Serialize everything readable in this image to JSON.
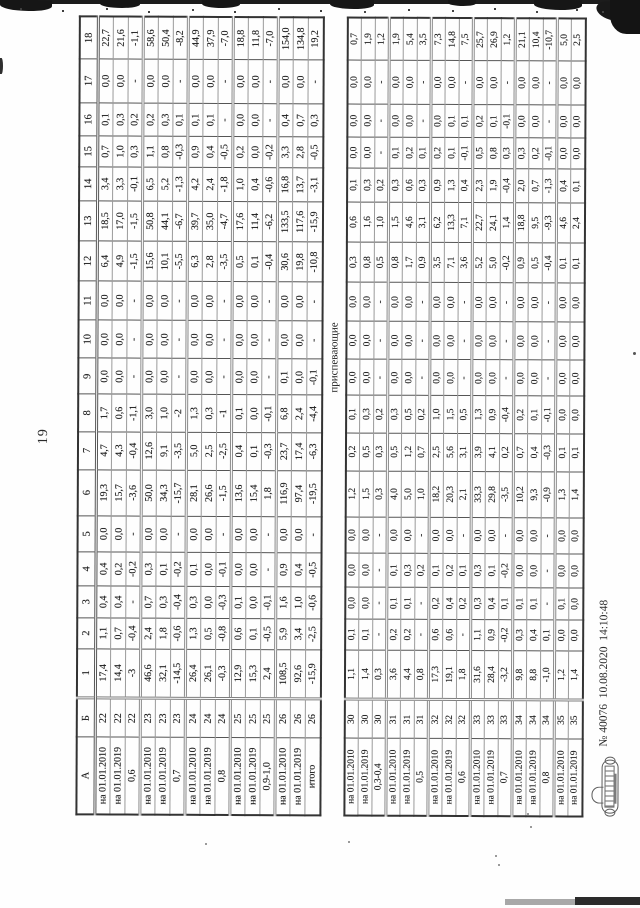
{
  "page": {
    "number": "19"
  },
  "table": {
    "header": [
      "А",
      "Б",
      "1",
      "2",
      "3",
      "4",
      "5",
      "6",
      "7",
      "8",
      "9",
      "10",
      "11",
      "12",
      "13",
      "14",
      "15",
      "16",
      "17",
      "18"
    ],
    "block1": {
      "rows": [
        [
          "на 01.01.2010",
          "22",
          "17,4",
          "1,1",
          "0,4",
          "0,4",
          "0,0",
          "19,3",
          "4,7",
          "1,7",
          "0,0",
          "0,0",
          "0,0",
          "6,4",
          "18,5",
          "3,4",
          "0,7",
          "0,1",
          "0,0",
          "22,7"
        ],
        [
          "на 01.01.2019",
          "22",
          "14,4",
          "0,7",
          "0,4",
          "0,2",
          "0,0",
          "15,7",
          "4,3",
          "0,6",
          "0,0",
          "0,0",
          "0,0",
          "4,9",
          "17,0",
          "3,3",
          "1,0",
          "0,3",
          "0,0",
          "21,6"
        ],
        [
          "0,6",
          "22",
          "-3",
          "-0,4",
          "-",
          "-0,2",
          "-",
          "-3,6",
          "-0,4",
          "-1,1",
          "-",
          "-",
          "-",
          "-1,5",
          "-1,5",
          "-0,1",
          "0,3",
          "0,2",
          "-",
          "-1,1"
        ],
        [
          "на 01.01.2010",
          "23",
          "46,6",
          "2,4",
          "0,7",
          "0,3",
          "0,0",
          "50,0",
          "12,6",
          "3,0",
          "0,0",
          "0,0",
          "0,0",
          "15,6",
          "50,8",
          "6,5",
          "1,1",
          "0,2",
          "0,0",
          "58,6"
        ],
        [
          "на 01.01.2019",
          "23",
          "32,1",
          "1,8",
          "0,3",
          "0,1",
          "0,0",
          "34,3",
          "9,1",
          "1,0",
          "0,0",
          "0,0",
          "0,0",
          "10,1",
          "44,1",
          "5,2",
          "0,8",
          "0,3",
          "0,0",
          "50,4"
        ],
        [
          "0,7",
          "23",
          "-14,5",
          "-0,6",
          "-0,4",
          "-0,2",
          "-",
          "-15,7",
          "-3,5",
          "-2",
          "-",
          "-",
          "-",
          "-5,5",
          "-6,7",
          "-1,3",
          "-0,3",
          "0,1",
          "-",
          "-8,2"
        ],
        [
          "на 01.01.2010",
          "24",
          "26,4",
          "1,3",
          "0,3",
          "0,1",
          "0,0",
          "28,1",
          "5,0",
          "1,3",
          "0,0",
          "0,0",
          "0,0",
          "6,3",
          "39,7",
          "4,2",
          "0,9",
          "0,1",
          "0,0",
          "44,9"
        ],
        [
          "на 01.01.2019",
          "24",
          "26,1",
          "0,5",
          "0,0",
          "0,0",
          "0,0",
          "26,6",
          "2,5",
          "0,3",
          "0,0",
          "0,0",
          "0,0",
          "2,8",
          "35,0",
          "2,4",
          "0,4",
          "0,1",
          "0,0",
          "37,9"
        ],
        [
          "0,8",
          "24",
          "-0,3",
          "-0,8",
          "-0,3",
          "-0,1",
          "-",
          "-1,5",
          "-2,5",
          "-1",
          "-",
          "-",
          "-",
          "-3,5",
          "-4,7",
          "-1,8",
          "-0,5",
          "-",
          "-",
          "-7,0"
        ],
        [
          "на 01.01.2010",
          "25",
          "12,9",
          "0,6",
          "0,1",
          "0,0",
          "0,0",
          "13,6",
          "0,4",
          "0,1",
          "0,0",
          "0,0",
          "0,0",
          "0,5",
          "17,6",
          "1,0",
          "0,2",
          "0,0",
          "0,0",
          "18,8"
        ],
        [
          "на 01.01.2019",
          "25",
          "15,3",
          "0,1",
          "0,0",
          "0,0",
          "0,0",
          "15,4",
          "0,1",
          "0,0",
          "0,0",
          "0,0",
          "0,0",
          "0,1",
          "11,4",
          "0,4",
          "0,0",
          "0,0",
          "0,0",
          "11,8"
        ],
        [
          "0,9-1,0",
          "25",
          "2,4",
          "-0,5",
          "-0,1",
          "-",
          "-",
          "1,8",
          "-0,3",
          "-0,1",
          "-",
          "-",
          "-",
          "-0,4",
          "-6,2",
          "-0,6",
          "-0,2",
          "-",
          "-",
          "-7,0"
        ],
        [
          "на 01.01.2010",
          "26",
          "108,5",
          "5,9",
          "1,6",
          "0,9",
          "0,0",
          "116,9",
          "23,7",
          "6,8",
          "0,1",
          "0,0",
          "0,0",
          "30,6",
          "133,5",
          "16,8",
          "3,3",
          "0,4",
          "0,0",
          "154,0"
        ],
        [
          "на 01.01.2019",
          "26",
          "92,6",
          "3,4",
          "1,0",
          "0,4",
          "0,0",
          "97,4",
          "17,4",
          "2,4",
          "0,0",
          "0,0",
          "0,0",
          "19,8",
          "117,6",
          "13,7",
          "2,8",
          "0,7",
          "0,0",
          "134,8"
        ],
        [
          "итого",
          "26",
          "-15,9",
          "-2,5",
          "-0,6",
          "-0,5",
          "-",
          "-19,5",
          "-6,3",
          "-4,4",
          "-0,1",
          "-",
          "-",
          "-10,8",
          "-15,9",
          "-3,1",
          "-0,5",
          "0,3",
          "-",
          "19,2"
        ]
      ]
    },
    "block2": {
      "label": "приспевающие",
      "rows": [
        [
          "на 01.01.2010",
          "30",
          "1,1",
          "0,1",
          "0,0",
          "0,0",
          "0,0",
          "1,2",
          "0,2",
          "0,1",
          "0,0",
          "0,0",
          "0,0",
          "0,3",
          "0,6",
          "0,1",
          "0,0",
          "0,0",
          "0,0",
          "0,7"
        ],
        [
          "на 01.01.2019",
          "30",
          "1,4",
          "0,1",
          "0,0",
          "0,0",
          "0,0",
          "1,5",
          "0,5",
          "0,3",
          "0,0",
          "0,0",
          "0,0",
          "0,8",
          "1,6",
          "0,3",
          "0,0",
          "0,0",
          "0,0",
          "1,9"
        ],
        [
          "0,3-0,4",
          "30",
          "0,3",
          "-",
          "-",
          "-",
          "-",
          "0,3",
          "0,3",
          "0,2",
          "-",
          "-",
          "-",
          "0,5",
          "1,0",
          "0,2",
          "-",
          "-",
          "-",
          "1,2"
        ],
        [
          "на 01.01.2010",
          "31",
          "3,6",
          "0,2",
          "0,1",
          "0,1",
          "0,0",
          "4,0",
          "0,5",
          "0,3",
          "0,0",
          "0,0",
          "0,0",
          "0,8",
          "1,5",
          "0,3",
          "0,1",
          "0,0",
          "0,0",
          "1,9"
        ],
        [
          "на 01.01.2019",
          "31",
          "4,4",
          "0,2",
          "0,1",
          "0,3",
          "0,0",
          "5,0",
          "1,2",
          "0,5",
          "0,0",
          "0,0",
          "0,0",
          "1,7",
          "4,6",
          "0,6",
          "0,2",
          "0,0",
          "0,0",
          "5,4"
        ],
        [
          "0,5",
          "31",
          "0,8",
          "-",
          "-",
          "0,2",
          "-",
          "1,0",
          "0,7",
          "0,2",
          "-",
          "-",
          "-",
          "0,9",
          "3,1",
          "0,3",
          "0,1",
          "-",
          "-",
          "3,5"
        ],
        [
          "на 01.01.2010",
          "32",
          "17,3",
          "0,6",
          "0,2",
          "0,1",
          "0,0",
          "18,2",
          "2,5",
          "1,0",
          "0,0",
          "0,0",
          "0,0",
          "3,5",
          "6,2",
          "0,9",
          "0,2",
          "0,0",
          "0,0",
          "7,3"
        ],
        [
          "на 01.01.2019",
          "32",
          "19,1",
          "0,6",
          "0,4",
          "0,2",
          "0,0",
          "20,3",
          "5,6",
          "1,5",
          "0,0",
          "0,0",
          "0,0",
          "7,1",
          "13,3",
          "1,3",
          "0,1",
          "0,1",
          "0,0",
          "14,8"
        ],
        [
          "0,6",
          "32",
          "1,8",
          "-",
          "0,2",
          "0,1",
          "-",
          "2,1",
          "3,1",
          "0,5",
          "-",
          "-",
          "-",
          "3,6",
          "7,1",
          "0,4",
          "-0,1",
          "0,1",
          "-",
          "7,5"
        ],
        [
          "на 01.01.2010",
          "33",
          "31,6",
          "1,1",
          "0,3",
          "0,3",
          "0,0",
          "33,3",
          "3,9",
          "1,3",
          "0,0",
          "0,0",
          "0,0",
          "5,2",
          "22,7",
          "2,3",
          "0,5",
          "0,2",
          "0,0",
          "25,7"
        ],
        [
          "на 01.01.2019",
          "33",
          "28,4",
          "0,9",
          "0,4",
          "0,1",
          "0,0",
          "29,8",
          "4,1",
          "0,9",
          "0,0",
          "0,0",
          "0,0",
          "5,0",
          "24,1",
          "1,9",
          "0,8",
          "0,1",
          "0,0",
          "26,9"
        ],
        [
          "0,7",
          "33",
          "-3,2",
          "-0,2",
          "0,1",
          "-0,2",
          "-",
          "-3,5",
          "0,2",
          "-0,4",
          "-",
          "-",
          "-",
          "-0,2",
          "1,4",
          "-0,4",
          "0,3",
          "-0,1",
          "-",
          "1,2"
        ],
        [
          "на 01.01.2010",
          "34",
          "9,8",
          "0,3",
          "0,1",
          "0,0",
          "0,0",
          "10,2",
          "0,7",
          "0,2",
          "0,0",
          "0,0",
          "0,0",
          "0,9",
          "18,8",
          "2,0",
          "0,3",
          "0,0",
          "0,0",
          "21,1"
        ],
        [
          "на 01.01.2019",
          "34",
          "8,8",
          "0,4",
          "0,1",
          "0,0",
          "0,0",
          "9,3",
          "0,4",
          "0,1",
          "0,0",
          "0,0",
          "0,0",
          "0,5",
          "9,5",
          "0,7",
          "0,2",
          "0,0",
          "0,0",
          "10,4"
        ],
        [
          "0,8",
          "34",
          "-1,0",
          "0,1",
          "-",
          "-",
          "-",
          "-0,9",
          "-0,3",
          "-0,1",
          "-",
          "-",
          "-",
          "-0,4",
          "-9,3",
          "-1,3",
          "-0,1",
          "-",
          "-",
          "-10,7"
        ],
        [
          "на 01.01.2010",
          "35",
          "1,2",
          "0,0",
          "0,1",
          "0,0",
          "0,0",
          "1,3",
          "0,1",
          "0,0",
          "0,0",
          "0,0",
          "0,0",
          "0,1",
          "4,6",
          "0,4",
          "0,0",
          "0,0",
          "0,0",
          "5,0"
        ],
        [
          "на 01.01.2019",
          "35",
          "1,4",
          "0,0",
          "0,0",
          "0,0",
          "0,0",
          "1,4",
          "0,1",
          "0,0",
          "0,0",
          "0,0",
          "0,0",
          "0,1",
          "2,4",
          "0,1",
          "0,0",
          "0,0",
          "0,0",
          "2,5"
        ]
      ]
    }
  },
  "footer": {
    "stamp_icon": "emblem-stamp",
    "note": "№ 40076  10.08.2020  14:10:48"
  }
}
